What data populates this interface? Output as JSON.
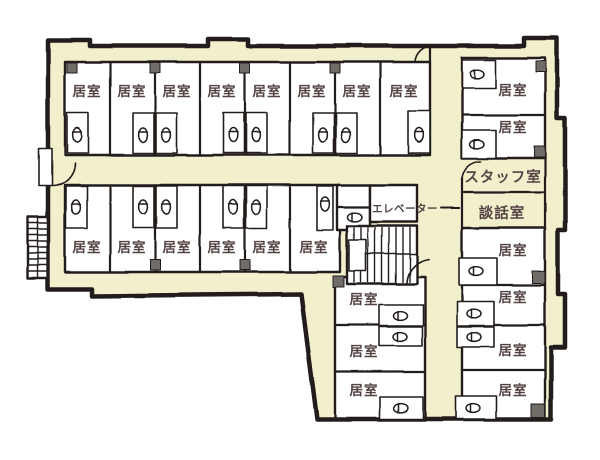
{
  "colors": {
    "corridor_fill": "#f1efcc",
    "room_fill": "#ffffff",
    "wall_ink": "#221f1a",
    "label_text": "#544343",
    "pillar_gray": "#6f6d69"
  },
  "labels": {
    "room": "居室",
    "staff_room": "スタッフ室",
    "lounge": "談話室",
    "elevator": "エレベーター"
  },
  "rooms": {
    "top_row": [
      "居室",
      "居室",
      "居室",
      "居室",
      "居室",
      "居室",
      "居室",
      "居室"
    ],
    "second_row": [
      "居室",
      "居室",
      "居室",
      "居室",
      "居室",
      "居室"
    ],
    "right_column_upper": [
      "居室",
      "居室"
    ],
    "right_column_lower": [
      "居室",
      "居室",
      "居室",
      "居室"
    ],
    "bottom_middle_column": [
      "居室",
      "居室",
      "居室"
    ]
  },
  "icons": {
    "toilet": "toilet-icon",
    "stairs": "stairs-icon",
    "door_swing": "door-swing-icon",
    "pillar": "pillar-marker"
  }
}
